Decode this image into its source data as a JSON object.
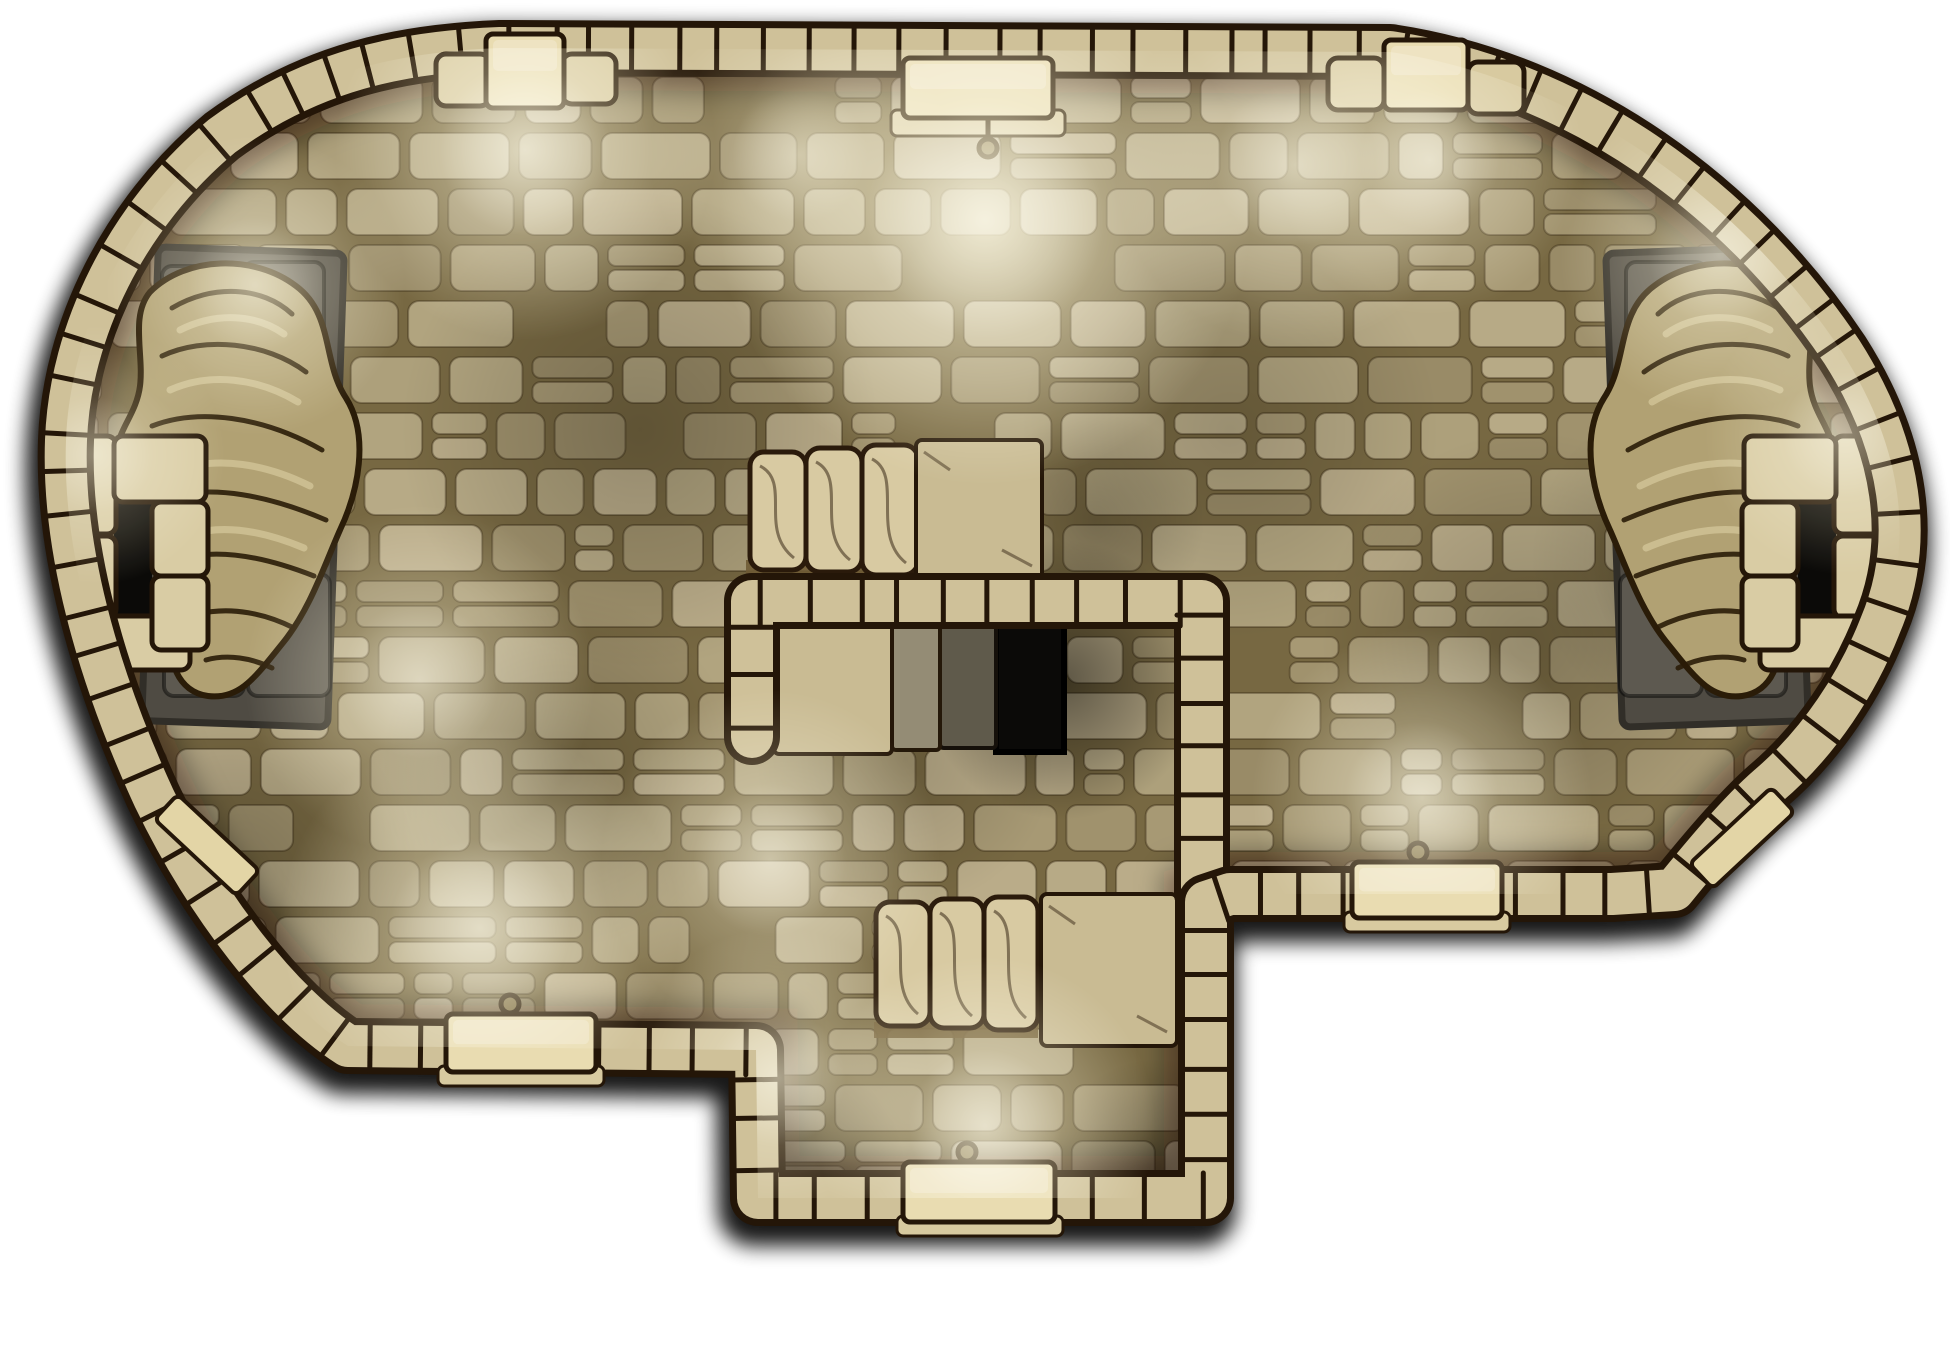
{
  "meta": {
    "title": "stone-dungeon-hall-battlemap",
    "type": "top-down fantasy battle map, no visible text",
    "canvas": {
      "width": 1950,
      "height": 1350
    }
  },
  "palette": {
    "background": "#ffffff",
    "grout": "#82734a",
    "bricks": [
      "#c8ba93",
      "#bcad86",
      "#cfc19b",
      "#b3a57e",
      "#c3b58e",
      "#d2c49f",
      "#ab9d77"
    ],
    "brick_stroke": "rgba(44,29,12,0.35)",
    "wall_fill": "#cfc199",
    "wall_outline": "#241608",
    "door_fill": "#e9dcb1",
    "door_sill": "#d8caa0",
    "knob_fill": "#7a6a42",
    "step_fill": "#d8caa2",
    "step_outline": "#2a1a0b",
    "landing_fill": "#c9bb93",
    "stair_base": "#6f5b35",
    "slab_gray_light": "#948c75",
    "slab_gray_dark": "#5f5a4b",
    "pit": "#0b0a08",
    "platform_fill": "#4f4b43",
    "platform_stone": "#5d5950",
    "platform_outline": "#312e28",
    "statue_fill": "#b1a173",
    "statue_line": "#2a1c08",
    "statue_highlight": "#e6d9ad",
    "ring_fill": "#d9cca4",
    "beam_fill": "#e3d5a6",
    "glow": "#fff4cd",
    "overlay": "rgba(64,50,22,0.16)"
  },
  "map": {
    "outline": "M 500,48 L 1390,52 C 1580,80 1742,202 1842,352 C 1902,446 1916,542 1880,626 C 1858,682 1820,742 1768,786 C 1738,812 1700,858 1674,890 L 1612,894 L 1230,894 L 1206,902 L 1206,1198 L 758,1198 L 756,1050 L 348,1046 C 282,1004 206,906 154,798 C 96,672 62,546 66,440 C 70,332 126,216 222,136 C 312,70 402,52 500,48 Z",
    "inner_wall": "M 752,737 L 752,601 L 1202,601 L 1202,893",
    "wall": {
      "band_width": 42,
      "outline_width": 56,
      "tick_min": 36,
      "tick_max": 56
    },
    "floor": {
      "row_height": 56,
      "min_w": 48,
      "max_w": 122,
      "corner_radius": 11,
      "split_prob": 0.24,
      "seed": 7
    },
    "doors": [
      {
        "name": "door-top-left",
        "slab": [
          486,
          34,
          78,
          74
        ],
        "knob": null,
        "jambs": [
          [
            436,
            54,
            54,
            52
          ],
          [
            562,
            54,
            54,
            50
          ]
        ],
        "sill": null
      },
      {
        "name": "door-top-center",
        "slab": [
          903,
          58,
          150,
          60
        ],
        "knob": [
          988,
          148
        ],
        "jambs": [],
        "sill": [
          891,
          110,
          174,
          26
        ]
      },
      {
        "name": "door-top-right",
        "slab": [
          1384,
          40,
          84,
          70
        ],
        "knob": null,
        "jambs": [
          [
            1328,
            58,
            56,
            52
          ],
          [
            1468,
            62,
            56,
            52
          ]
        ],
        "sill": null
      },
      {
        "name": "door-bottom-left",
        "slab": [
          446,
          1014,
          150,
          58
        ],
        "knob": [
          510,
          1004
        ],
        "jambs": [],
        "sill": [
          438,
          1066,
          166,
          20
        ]
      },
      {
        "name": "door-right",
        "slab": [
          1352,
          862,
          150,
          56
        ],
        "knob": [
          1418,
          852
        ],
        "jambs": [],
        "sill": [
          1344,
          912,
          166,
          20
        ]
      },
      {
        "name": "door-bottom",
        "slab": [
          903,
          1162,
          152,
          60
        ],
        "knob": [
          967,
          1152
        ],
        "jambs": [],
        "sill": [
          897,
          1216,
          166,
          20
        ]
      }
    ],
    "glows": [
      [
        525,
        150,
        190,
        0.6
      ],
      [
        800,
        155,
        150,
        0.4
      ],
      [
        985,
        220,
        265,
        0.75
      ],
      [
        1295,
        165,
        180,
        0.5
      ],
      [
        1430,
        160,
        155,
        0.45
      ],
      [
        1720,
        255,
        160,
        0.45
      ],
      [
        255,
        285,
        150,
        0.45
      ],
      [
        420,
        680,
        175,
        0.45
      ],
      [
        95,
        455,
        130,
        0.35
      ],
      [
        1845,
        435,
        140,
        0.35
      ],
      [
        480,
        928,
        200,
        0.55
      ],
      [
        770,
        860,
        170,
        0.45
      ],
      [
        778,
        1078,
        150,
        0.45
      ],
      [
        985,
        1126,
        170,
        0.55
      ],
      [
        1422,
        798,
        170,
        0.5
      ]
    ],
    "shadows": [
      [
        640,
        430,
        240,
        0.2
      ],
      [
        1230,
        430,
        210,
        0.16
      ],
      [
        560,
        770,
        180,
        0.16
      ],
      [
        1530,
        640,
        210,
        0.18
      ],
      [
        1062,
        680,
        140,
        0.5
      ],
      [
        230,
        880,
        190,
        0.22
      ],
      [
        1700,
        560,
        170,
        0.18
      ],
      [
        210,
        560,
        150,
        0.28
      ],
      [
        1740,
        560,
        150,
        0.25
      ],
      [
        905,
        760,
        150,
        0.15
      ],
      [
        795,
        1168,
        110,
        0.28
      ],
      [
        1158,
        1168,
        110,
        0.28
      ],
      [
        1095,
        520,
        110,
        0.2
      ]
    ],
    "stairs": [
      {
        "name": "upper-stairs",
        "steps": [
          [
            750,
            452,
            56,
            118
          ],
          [
            806,
            448,
            56,
            124
          ],
          [
            862,
            445,
            56,
            130
          ]
        ],
        "base": [
          746,
          560,
          174,
          18
        ],
        "landing": [
          916,
          440,
          126,
          140
        ]
      },
      {
        "name": "lower-stairs",
        "steps": [
          [
            876,
            902,
            54,
            124
          ],
          [
            930,
            899,
            54,
            129
          ],
          [
            984,
            897,
            54,
            133
          ]
        ],
        "base": [
          874,
          1022,
          164,
          16
        ],
        "landing": [
          1041,
          894,
          136,
          152
        ]
      }
    ],
    "vault": {
      "slab": [
        774,
        616,
        118,
        138
      ],
      "gray_slabs": [
        [
          892,
          620,
          48,
          130
        ],
        [
          940,
          620,
          56,
          128
        ]
      ],
      "pit": [
        996,
        616,
        68,
        136
      ],
      "lintel_shadow": [
        770,
        612,
        300,
        12
      ]
    },
    "alcove": {
      "platform": [
        150,
        250,
        186,
        474
      ],
      "platform_stones": [
        [
          162,
          266,
          78,
          88
        ],
        [
          244,
          262,
          80,
          92
        ],
        [
          160,
          360,
          80,
          96
        ],
        [
          244,
          358,
          82,
          98
        ],
        [
          162,
          462,
          80,
          108
        ],
        [
          246,
          460,
          82,
          110
        ],
        [
          164,
          576,
          80,
          120
        ],
        [
          248,
          574,
          82,
          122
        ]
      ],
      "ring_blocks": [
        [
          64,
          436,
          52,
          98
        ],
        [
          64,
          536,
          52,
          82
        ],
        [
          66,
          616,
          124,
          54
        ],
        [
          114,
          436,
          92,
          66
        ],
        [
          152,
          502,
          56,
          74
        ],
        [
          152,
          576,
          56,
          74
        ]
      ],
      "ring_hole": [
        114,
        502,
        38,
        114
      ],
      "statue_body": "M150,292 C186,256 254,254 296,286 C334,314 322,362 346,398 C370,436 358,492 340,530 C324,566 310,610 282,644 C256,676 240,700 208,696 C178,692 166,660 174,630 C182,602 170,572 158,540 C146,508 120,498 116,466 C112,434 136,418 140,386 C144,354 130,316 150,292 Z",
      "statue_folds": [
        "M172,308 C212,284 262,286 292,314",
        "M162,356 C204,336 266,342 306,372",
        "M152,426 C198,408 262,416 322,450",
        "M168,498 C212,484 270,496 326,520",
        "M184,558 C222,548 268,558 314,576",
        "M198,614 C232,606 266,614 294,628",
        "M206,660 C228,654 252,658 272,668"
      ],
      "statue_hilites": [
        "M180,330 C216,312 256,314 284,334",
        "M170,390 C210,372 258,378 298,402",
        "M178,470 C218,456 266,464 310,486",
        "M192,534 C226,524 266,532 304,548"
      ]
    },
    "beams": [
      {
        "cx": 1742,
        "cy": 838,
        "len": 112,
        "w": 34,
        "angle": -43
      },
      {
        "cx": 207,
        "cy": 845,
        "len": 112,
        "w": 34,
        "angle": 43
      }
    ]
  }
}
